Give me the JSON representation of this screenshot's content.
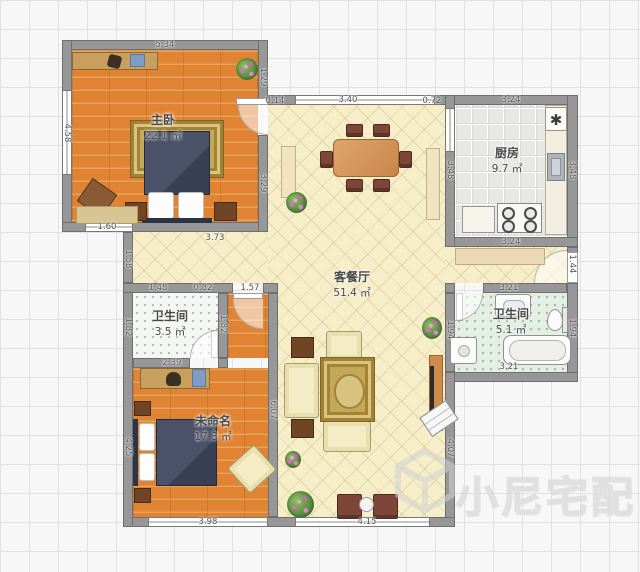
{
  "watermark": {
    "text": "小尼宅配"
  },
  "icons": {
    "kitchen_fixture": "✱"
  },
  "rooms": {
    "master": {
      "name": "主卧",
      "area": "22.1 ㎡"
    },
    "kitchen": {
      "name": "厨房",
      "area": "9.7 ㎡"
    },
    "living": {
      "name": "客餐厅",
      "area": "51.4 ㎡"
    },
    "bath_small": {
      "name": "卫生间",
      "area": "3.5 ㎡"
    },
    "bath_large": {
      "name": "卫生间",
      "area": "5.1 ㎡"
    },
    "bedroom2": {
      "name": "未命名",
      "area": "17.3 ㎡"
    }
  },
  "dims": {
    "mb_top": "5.34",
    "mb_left": "4.58",
    "mb_right_upper": "1.29",
    "mb_door": "0.14",
    "mb_right_lower": "3.29",
    "mb_window": "1.60",
    "mb_bottom": "3.73",
    "living_top": "3.40",
    "living_top_right": "0.72",
    "living_bottom": "4.15",
    "living_right": "4.07",
    "kitchen_top": "3.24",
    "kitchen_bottom": "3.24",
    "kitchen_left": "3.48",
    "kitchen_right": "3.48",
    "entry_door": "1.44",
    "corridor_left": "1.58",
    "bathS_top_a": "1.48",
    "bathS_top_b": "0.82",
    "nook_top": "1.57",
    "bathS_left": "1.82",
    "bathS_right": "1.82",
    "bathS_bottom": "2.39",
    "bed2_left": "4.25",
    "bed2_right": "6.07",
    "bed2_bottom": "3.98",
    "bathL_top": "3.21",
    "bathL_bottom": "3.21",
    "bathL_left": "1.94",
    "bathL_right": "1.94"
  },
  "colors": {
    "wall": "#979797",
    "wood_floor": "#e08434",
    "tile_cream": "#f6eec9",
    "rug_gold": "#c3a85a",
    "duvet_navy": "#424960"
  }
}
